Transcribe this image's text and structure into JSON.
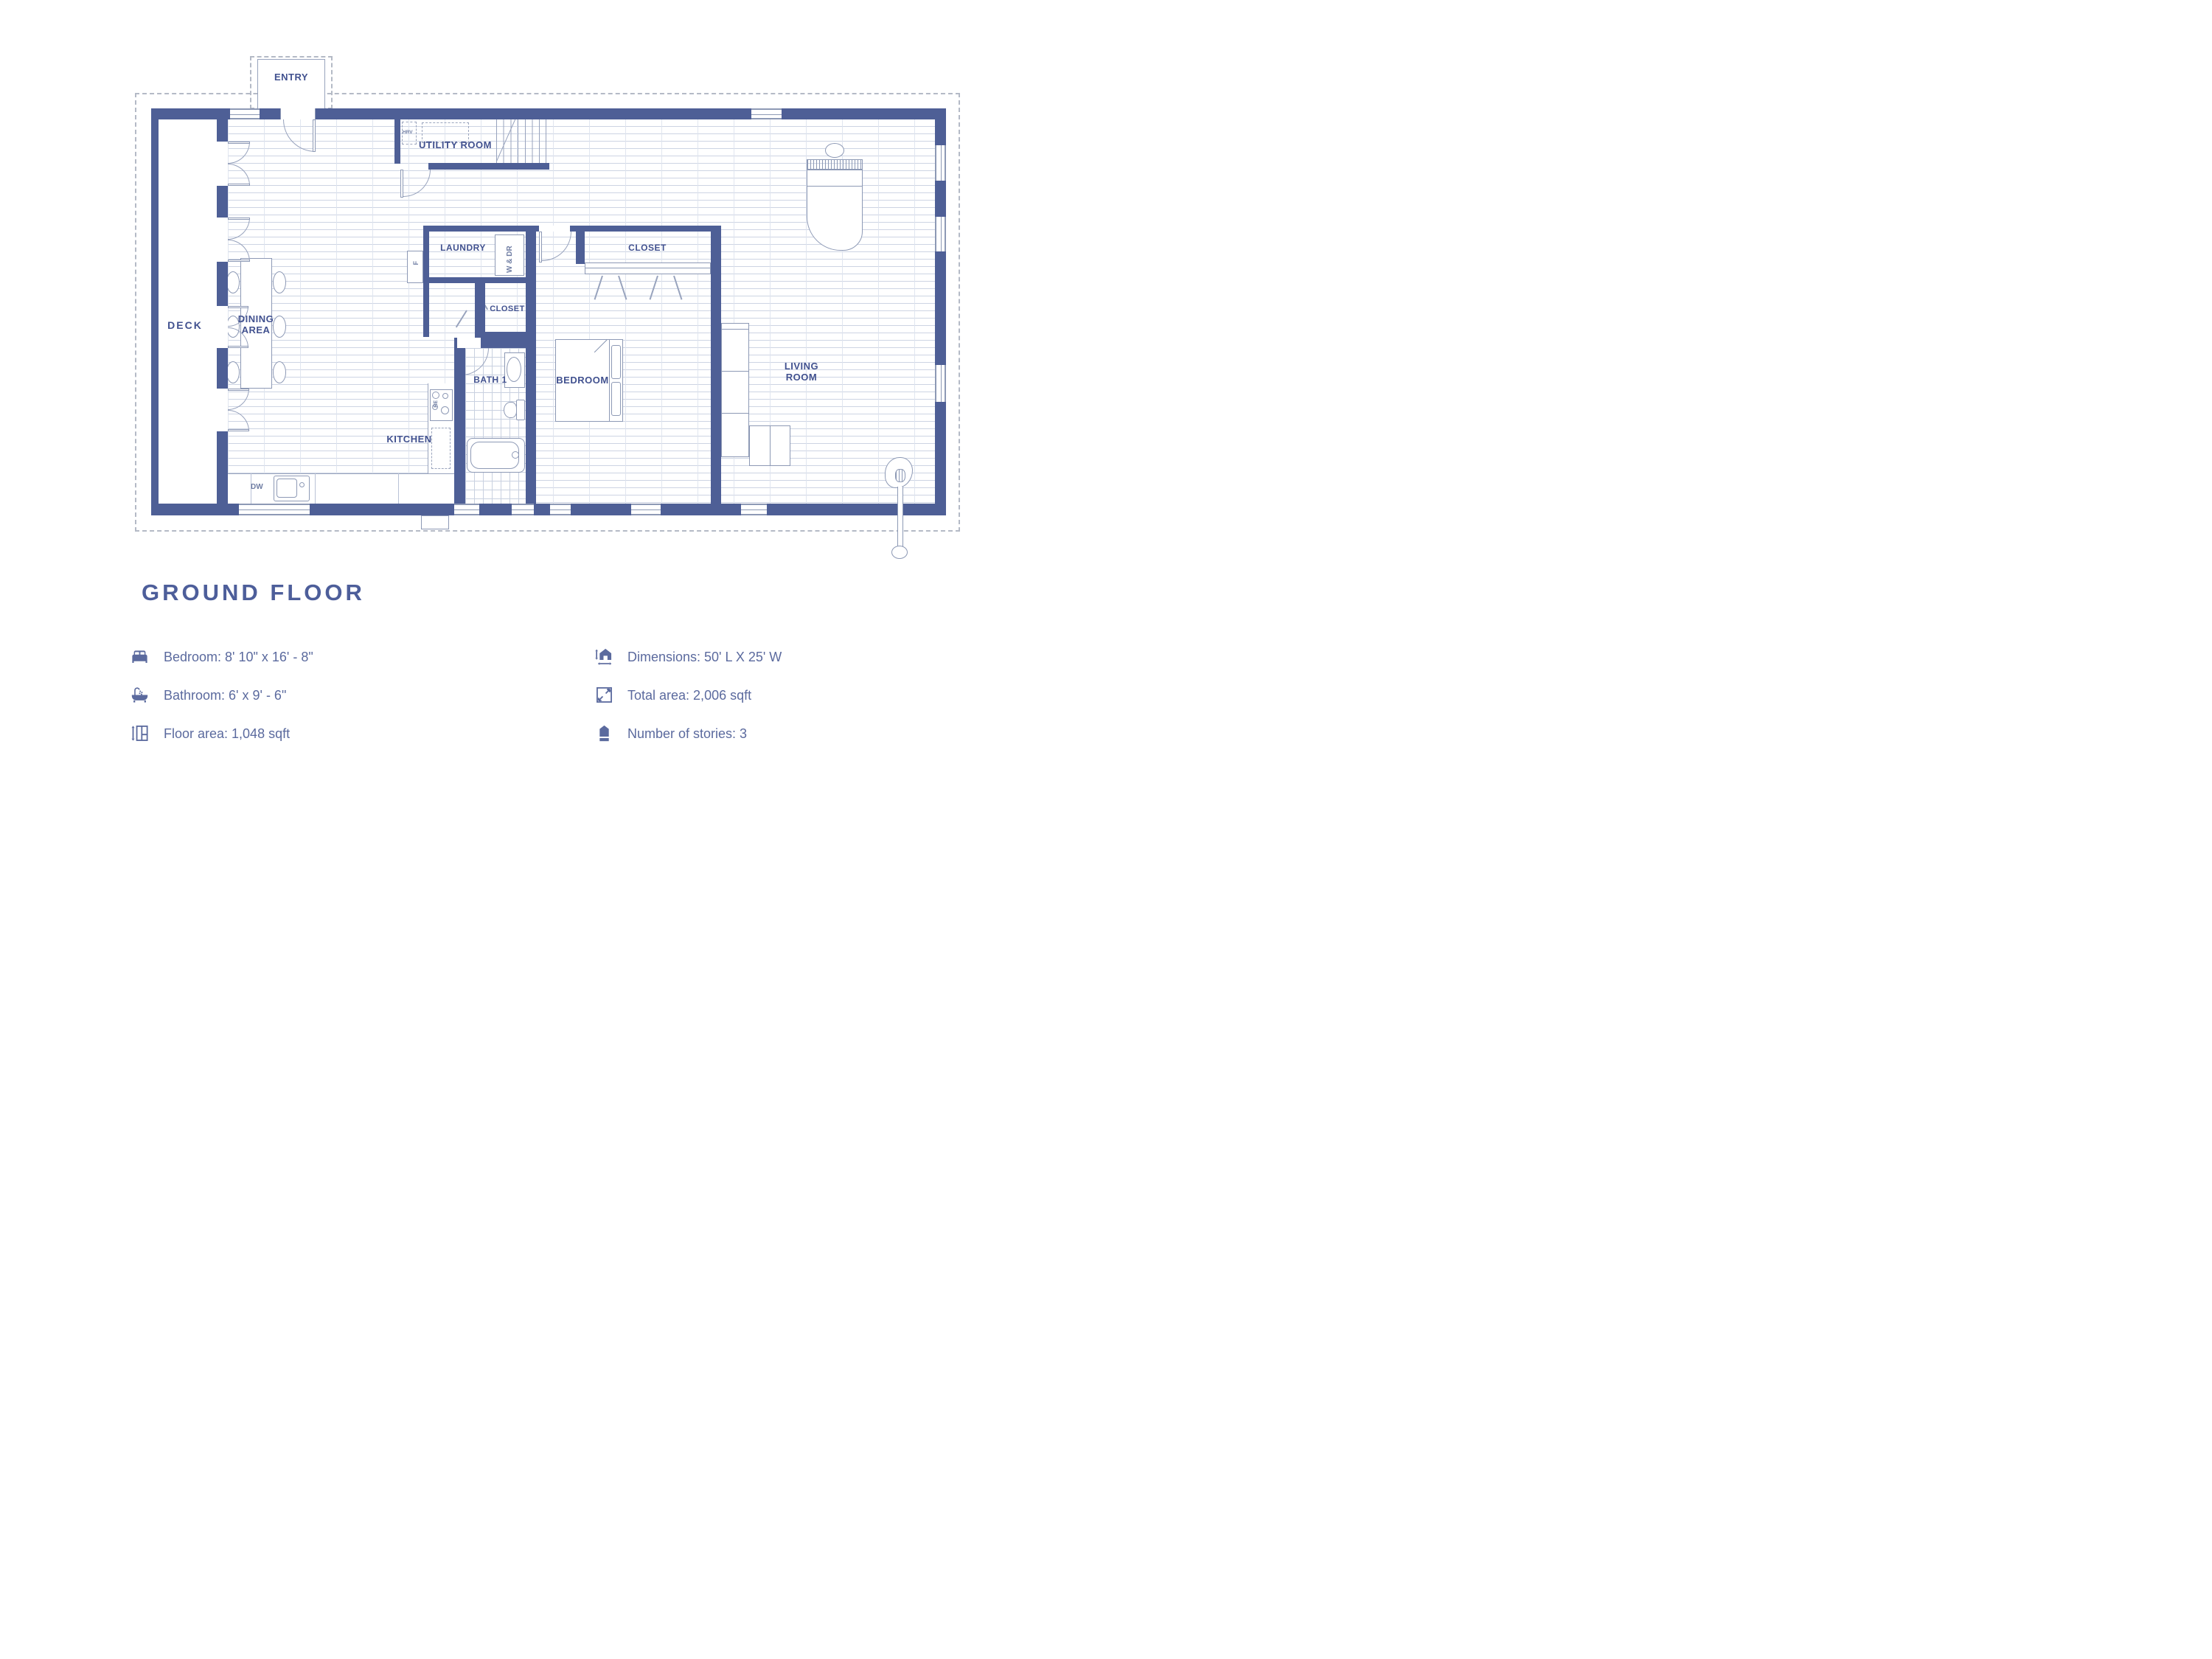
{
  "title": "GROUND FLOOR",
  "colors": {
    "wall": "#4e5f96",
    "label": "#41518f",
    "legend_text": "#5b6a9e",
    "outline": "#8d99b5"
  },
  "plan": {
    "rooms": {
      "entry": "ENTRY",
      "utility": "UTILITY ROOM",
      "deck": "DECK",
      "dining": "DINING AREA",
      "kitchen": "KITCHEN",
      "laundry": "LAUNDRY",
      "closet_hall": "CLOSET",
      "closet_bedroom": "CLOSET",
      "bath": "BATH 1",
      "bedroom": "BEDROOM",
      "living": "LIVING ROOM"
    },
    "fixtures": {
      "hrv": "HRV",
      "washer_dryer": "W & DR",
      "fridge": "F",
      "dishwasher": "DW",
      "range": "RE"
    }
  },
  "legend": {
    "items": [
      {
        "icon": "bed-icon",
        "text": "Bedroom: 8' 10\" x 16' - 8\""
      },
      {
        "icon": "bathtub-icon",
        "text": "Bathroom: 6' x 9' - 6\""
      },
      {
        "icon": "floor-area-icon",
        "text": "Floor area: 1,048 sqft"
      },
      {
        "icon": "dimensions-icon",
        "text": "Dimensions: 50' L X 25' W"
      },
      {
        "icon": "total-area-icon",
        "text": "Total area: 2,006 sqft"
      },
      {
        "icon": "stories-icon",
        "text": "Number of stories: 3"
      }
    ]
  }
}
